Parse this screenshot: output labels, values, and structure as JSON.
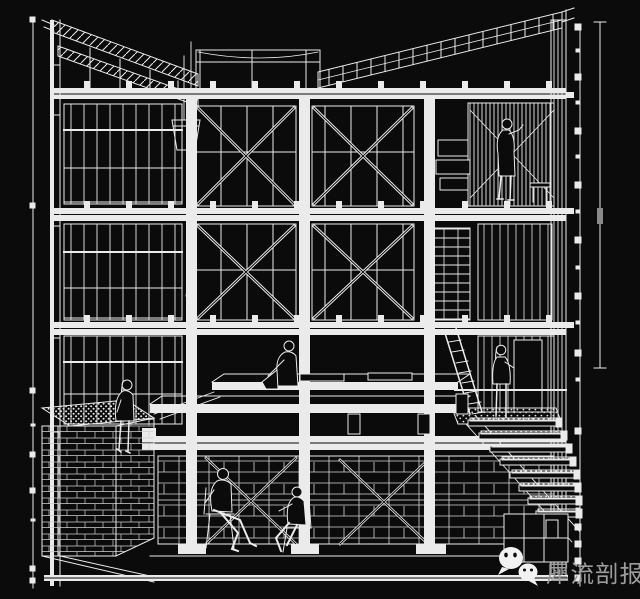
{
  "canvas": {
    "width": 640,
    "height": 599
  },
  "colors": {
    "background": "#0b0b0b",
    "line": "#ebebeb",
    "line_dim": "#cfcfcf",
    "watermark_text": "#9c9c9c",
    "watermark_icon": "#f2f2f2"
  },
  "drawing": {
    "type": "architectural-section-axonometric-wireframe",
    "style": "white line art on black background",
    "stories": [
      "butterfly roof truss with hatched rafters",
      "upper floor with cross-braced window bays",
      "middle floor with cross-braced window bays and shelving",
      "ground floor with stepped timber deck platform",
      "basement lounge with block walls"
    ],
    "figures": [
      {
        "name": "standing-man-upper-right",
        "pose": "standing at shelf wall, upper floor right"
      },
      {
        "name": "seated-person-center-deck",
        "pose": "sitting on deck edge, knees drawn up"
      },
      {
        "name": "seated-woman-left-counter",
        "pose": "sitting on planted counter, legs dangling"
      },
      {
        "name": "standing-woman-stairs",
        "pose": "standing at top of the stair landing"
      },
      {
        "name": "seated-man-basement-left",
        "pose": "sitting on chair, legs stretched out"
      },
      {
        "name": "seated-man-basement-right",
        "pose": "sitting on chair facing left"
      }
    ],
    "props": [
      "hanging bucket on rope",
      "inclined ladder",
      "stacked shelf boxes",
      "descending stair with gravel treads",
      "gravel/planted counter top",
      "dimension rulers with square ticks"
    ]
  },
  "rulers": {
    "left": {
      "square_ticks_y": [
        17,
        203,
        388,
        452,
        488,
        566,
        578
      ],
      "minor_ticks_y": [
        424,
        519
      ]
    },
    "right": {
      "square_ticks_y": [
        24,
        74,
        128,
        182,
        237,
        293,
        350,
        428,
        524,
        541,
        558,
        575
      ],
      "minor_ticks_y": [
        49,
        101,
        155,
        210,
        266,
        321,
        378,
        470,
        508
      ]
    }
  },
  "watermark": {
    "text": "犀流剖报",
    "icon": "wechat-logo"
  }
}
